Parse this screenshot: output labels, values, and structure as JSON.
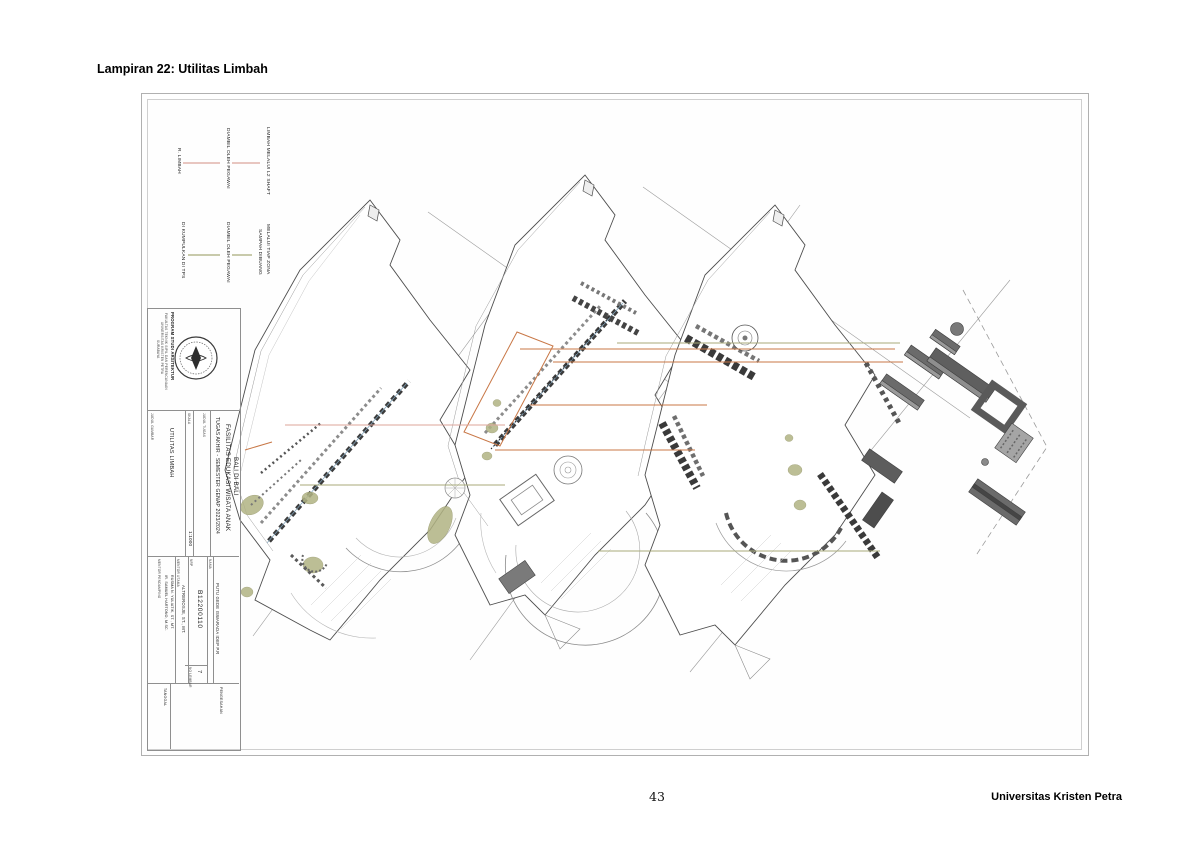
{
  "page": {
    "header": "Lampiran 22: Utilitas Limbah",
    "page_number": "43",
    "footer_right": "Universitas Kristen Petra"
  },
  "legend": {
    "limbah": {
      "room": "R. LIMBAH",
      "middle": "DIAMBIL OLEH PEGAWAI",
      "source": "LIMBAH MELALUI L2 SHAFT",
      "line_color": "#dca49a"
    },
    "sampah": {
      "destination": "DI KUMPULKAN DI TPS",
      "middle": "DIAMBIL OLEH PEGAWAI",
      "source_line1": "SAMPAH DIBUANG",
      "source_line2": "MELALUI TIAP ZONA",
      "line_color": "#a8aa7a"
    }
  },
  "drawing_colors": {
    "orange_connector": "#c87746",
    "olive_patch": "#b1b383",
    "line_art": "#4d4d4d"
  },
  "titleblock": {
    "institution_line1": "PROGRAM STUDI ARSITEKTUR",
    "institution_line2": "FAKULTAS TEKNIK SIPIL DAN PERENCANAAN",
    "institution_line3": "UNIVERSITAS KRISTEN PETRA",
    "institution_line4": "SURABAYA",
    "course": "TUGAS AKHIR - SEMESTER GENAP 2023/2024",
    "judul_tugas_label": "JUDUL TUGAS",
    "project_title_line1": "FASILITAS EDUKASI WISATA ANAK",
    "project_title_line2": "BALI DI BALI",
    "judul_gambar_label": "JUDUL GAMBAR",
    "drawing_title": "UTILITAS LIMBAH",
    "skala_label": "SKALA",
    "scale": "1:1000",
    "nama_label": "NAMA",
    "student_name": "PUTU GEDE ISWARADA IDEP P.R",
    "nrp_label": "NRP",
    "student_id": "B12200110",
    "pembimbing_label": "MENTOR UTAMA",
    "pembimbing": "ALTREROSJE, ST., MT.",
    "pendamping_label": "MENTOR PENDAMPING",
    "pendamping_line1": "IR. SAMUEL HARTONO, M.SC.",
    "pendamping_line2": "RUSMA N. YULIATIK, ST., MT.",
    "no_lembar_label": "NO LEMBAR",
    "sheet_number": "7",
    "tanggal_label": "TANGGAL",
    "pengesahan_label": "PENGESAHAN"
  }
}
